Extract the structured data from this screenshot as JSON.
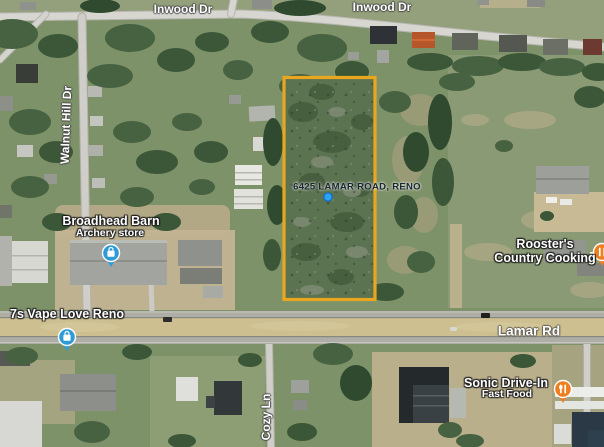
{
  "map": {
    "type": "satellite-map",
    "labels": {
      "inwood_left": "Inwood Dr",
      "inwood_right": "Inwood Dr",
      "walnut_hill": "Walnut Hill Dr",
      "lamar": "Lamar Rd",
      "cozy": "Cozy Ln",
      "broadhead_name": "Broadhead Barn",
      "broadhead_sub": "Archery store",
      "vape": "7s Vape Love Reno",
      "roosters_line1": "Rooster's",
      "roosters_line2": "Country Cooking",
      "sonic_name": "Sonic Drive-In",
      "sonic_sub": "Fast Food",
      "parcel": "6425 LAMAR ROAD, RENO"
    },
    "icons": [
      {
        "name": "shopping-pin",
        "glyph": "shopping-bag",
        "color": "#2E9BD6"
      },
      {
        "name": "restaurant-pin",
        "glyph": "fork-knife",
        "color": "#EF7E1F"
      },
      {
        "name": "location-dot",
        "glyph": "dot",
        "color": "#2AA3F0"
      }
    ],
    "colors": {
      "parcel_outline": "#E8A71E",
      "shopping_pin": "#2E9BD6",
      "restaurant_pin": "#EF7E1F",
      "marker_dot": "#2AA3F0",
      "road_major": "#CDBF90",
      "road_minor": "#D7D6D1"
    }
  }
}
